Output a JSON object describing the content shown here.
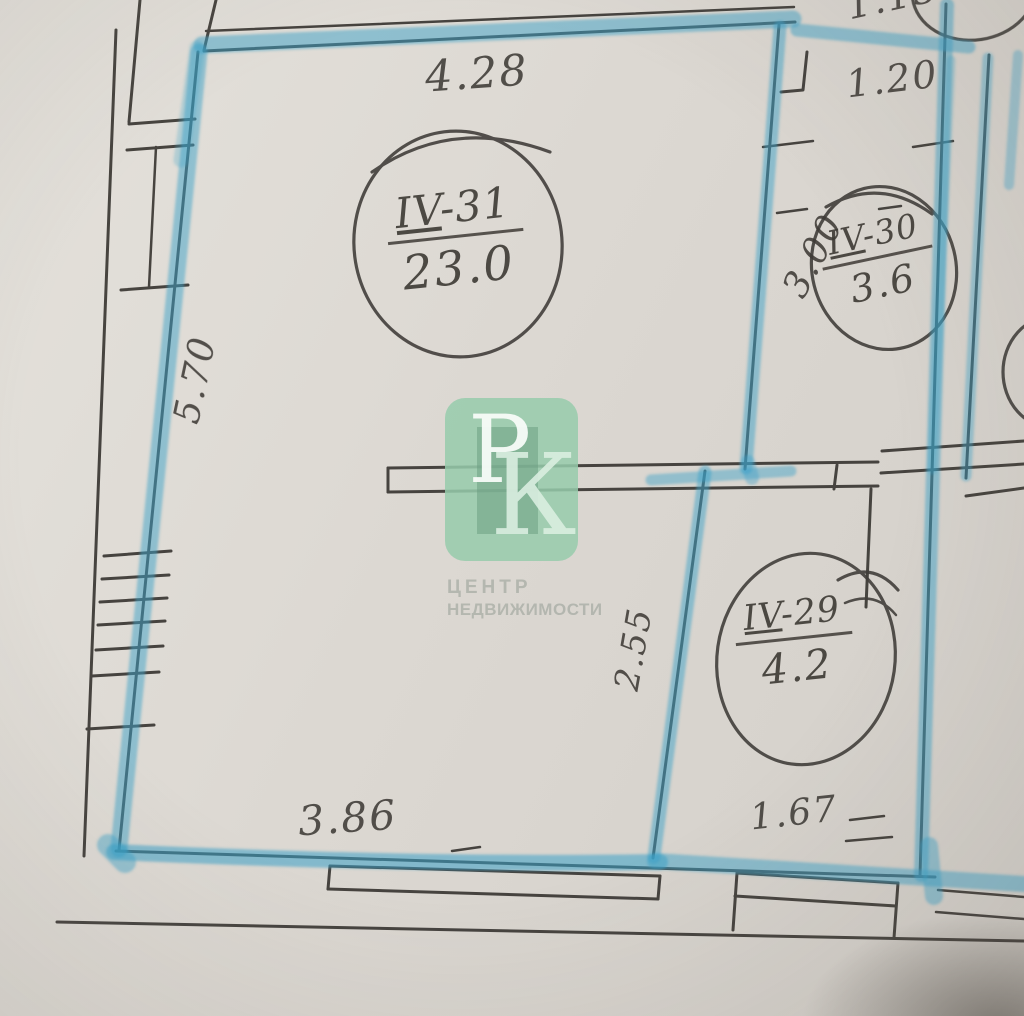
{
  "rooms": [
    {
      "numeral": "IV",
      "number": "-31",
      "area": "23.0"
    },
    {
      "numeral": "IV",
      "number": "-30",
      "area": "3.6"
    },
    {
      "numeral": "IV",
      "number": "-29",
      "area": "4.2"
    }
  ],
  "dimensions": {
    "top": "4.28",
    "top_right_partial": "1.13",
    "corridor_width": "1.20",
    "left_height": "5.70",
    "corridor_height": "3.00",
    "inner_height": "2.55",
    "bottom": "3.86",
    "bottom_right": "1.67"
  },
  "watermark": {
    "initial_top": "Р",
    "initial_bottom": "К",
    "caption_top": "ЦЕНТР",
    "caption_bottom": "НЕДВИЖИМОСТИ",
    "tile_color": "#97cbac"
  },
  "colors": {
    "paper": "#dbd7d1",
    "pen": "#3a3733",
    "marker": "#3ba1c7"
  }
}
